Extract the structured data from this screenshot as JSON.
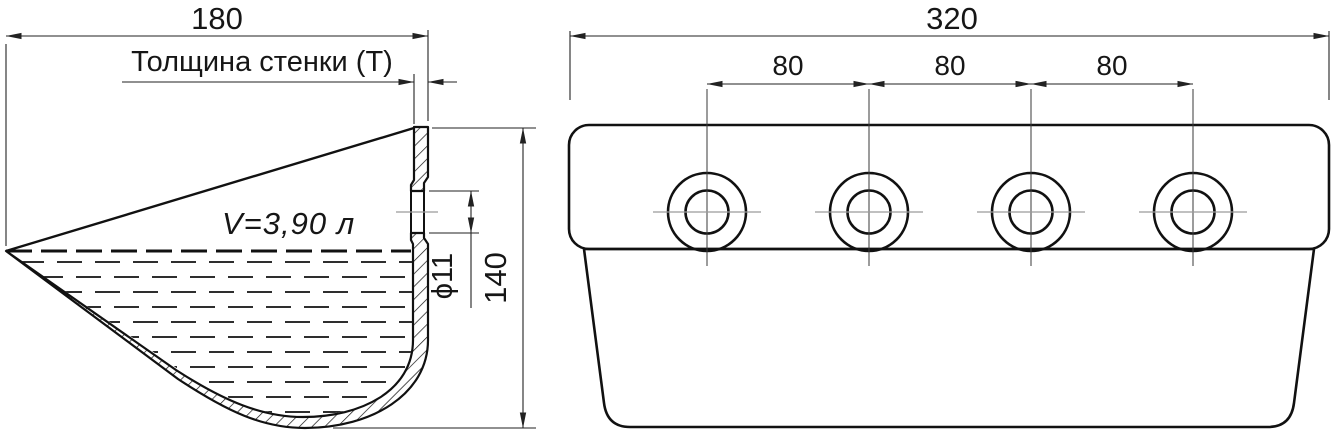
{
  "drawing": {
    "left_view": {
      "width_dim": "180",
      "wall_thickness_label": "Толщина стенки (Т)",
      "volume_label": "V=3,90 л",
      "hole_diameter_dim": "ϕ11",
      "height_dim": "140"
    },
    "right_view": {
      "width_dim": "320",
      "spacing_dims": [
        "80",
        "80",
        "80"
      ]
    },
    "colors": {
      "line": "#111111",
      "dimension_line": "#222222",
      "centerline": "#9a9a9a",
      "background": "#ffffff"
    }
  }
}
